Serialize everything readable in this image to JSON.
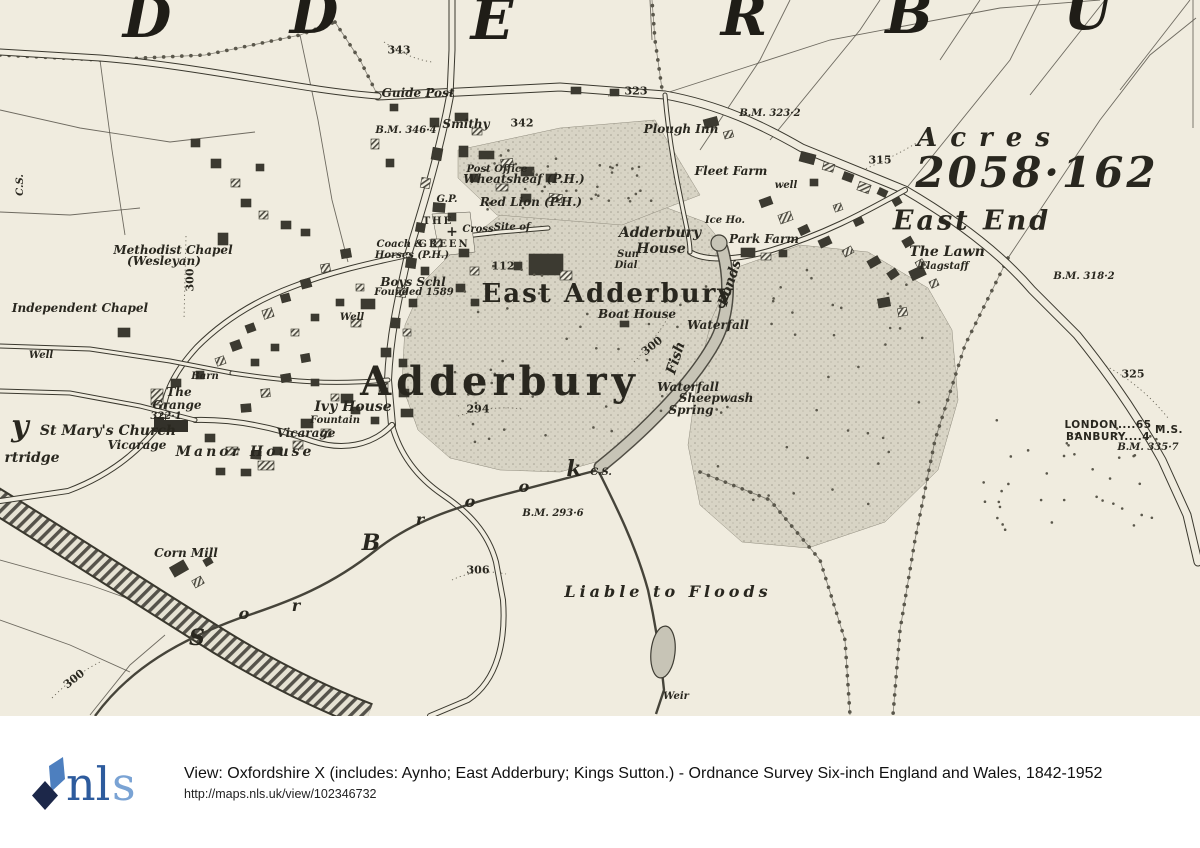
{
  "colors": {
    "paper": "#f0ecdf",
    "ink": "#3a382e",
    "line": "#57544a",
    "stipple_base": "#d8d4c5",
    "stipple_dot": "#a5a193",
    "water": "#c7c4b6",
    "tree": "#5a574b",
    "logo_light": "#4d7fbf",
    "logo_dark": "#1c2749",
    "nls_blue": "#2d5b9d",
    "nls_s": "#7aa3d4"
  },
  "footer": {
    "logo_nl": "nl",
    "logo_s": "s",
    "line1": "View: Oxfordshire X (includes: Aynho; East Adderbury; Kings Sutton.) - Ordnance Survey Six-inch England and Wales, 1842-1952",
    "line2": "http://maps.nls.uk/view/102346732"
  },
  "map": {
    "labels": [
      {
        "t": "D",
        "x": 147,
        "y": 18,
        "c": "g"
      },
      {
        "t": "D",
        "x": 314,
        "y": 14,
        "c": "g"
      },
      {
        "t": "E",
        "x": 492,
        "y": 20,
        "c": "g"
      },
      {
        "t": "R",
        "x": 744,
        "y": 16,
        "c": "g"
      },
      {
        "t": "B",
        "x": 909,
        "y": 14,
        "c": "g"
      },
      {
        "t": "U",
        "x": 1088,
        "y": 10,
        "c": "g"
      },
      {
        "t": "Acres",
        "x": 990,
        "y": 138,
        "c": "acres"
      },
      {
        "t": "2058·162",
        "x": 1037,
        "y": 173,
        "c": "acreage"
      },
      {
        "t": "East End",
        "x": 972,
        "y": 221,
        "c": "eastend"
      },
      {
        "t": "East Adderbury",
        "x": 608,
        "y": 294,
        "c": "town"
      },
      {
        "t": "Adderbury",
        "x": 500,
        "y": 382,
        "c": "townxl"
      },
      {
        "t": "Guide Post",
        "x": 418,
        "y": 93,
        "c": "p"
      },
      {
        "t": "Smithy",
        "x": 466,
        "y": 124,
        "c": "p"
      },
      {
        "t": "342",
        "x": 522,
        "y": 123,
        "c": "n"
      },
      {
        "t": "343",
        "x": 399,
        "y": 50,
        "c": "n"
      },
      {
        "t": "B.M. 346·4",
        "x": 406,
        "y": 131,
        "c": "bm"
      },
      {
        "t": "323",
        "x": 636,
        "y": 91,
        "c": "n"
      },
      {
        "t": "Plough Inn",
        "x": 681,
        "y": 129,
        "c": "p"
      },
      {
        "t": "B.M. 323·2",
        "x": 770,
        "y": 114,
        "c": "bm"
      },
      {
        "t": "Post Office",
        "x": 497,
        "y": 170,
        "c": "sm"
      },
      {
        "t": "Wheatsheaf (P.H.)",
        "x": 524,
        "y": 179,
        "c": "p"
      },
      {
        "t": "Red Lion (P.H.)",
        "x": 531,
        "y": 202,
        "c": "p"
      },
      {
        "t": "G.P.",
        "x": 447,
        "y": 200,
        "c": "sm"
      },
      {
        "t": "Fleet Farm",
        "x": 731,
        "y": 171,
        "c": "p"
      },
      {
        "t": "well",
        "x": 786,
        "y": 186,
        "c": "sm"
      },
      {
        "t": "315",
        "x": 880,
        "y": 160,
        "c": "n"
      },
      {
        "t": "Ice Ho.",
        "x": 725,
        "y": 221,
        "c": "sm"
      },
      {
        "t": "Park Farm",
        "x": 764,
        "y": 239,
        "c": "p"
      },
      {
        "t": "Adderbury",
        "x": 660,
        "y": 233,
        "c": "p2"
      },
      {
        "t": "House",
        "x": 661,
        "y": 249,
        "c": "p2"
      },
      {
        "t": "Sun",
        "x": 628,
        "y": 255,
        "c": "sm"
      },
      {
        "t": "Dial",
        "x": 626,
        "y": 266,
        "c": "sm"
      },
      {
        "t": "The Lawn",
        "x": 947,
        "y": 252,
        "c": "p2"
      },
      {
        "t": "Flagstaff",
        "x": 944,
        "y": 267,
        "c": "sm"
      },
      {
        "t": "B.M. 318·2",
        "x": 1084,
        "y": 277,
        "c": "bm"
      },
      {
        "t": "Methodist Chapel",
        "x": 173,
        "y": 250,
        "c": "p"
      },
      {
        "t": "(Wesleyan)",
        "x": 164,
        "y": 261,
        "c": "p"
      },
      {
        "t": "300",
        "x": 190,
        "y": 280,
        "c": "n",
        "r": -90
      },
      {
        "t": "Independent Chapel",
        "x": 80,
        "y": 308,
        "c": "p"
      },
      {
        "t": "Well",
        "x": 41,
        "y": 356,
        "c": "sm"
      },
      {
        "t": "Coach &",
        "x": 400,
        "y": 245,
        "c": "sm"
      },
      {
        "t": "Horses (P.H.)",
        "x": 412,
        "y": 256,
        "c": "sm"
      },
      {
        "t": "THE",
        "x": 438,
        "y": 222,
        "c": "green"
      },
      {
        "t": "GREEN",
        "x": 444,
        "y": 245,
        "c": "green"
      },
      {
        "t": "+",
        "x": 452,
        "y": 232,
        "c": "cross"
      },
      {
        "t": "Cross",
        "x": 478,
        "y": 230,
        "c": "sm"
      },
      {
        "t": "Site of",
        "x": 512,
        "y": 228,
        "c": "sm"
      },
      {
        "t": "112",
        "x": 503,
        "y": 266,
        "c": "n"
      },
      {
        "t": "Boys Schl",
        "x": 413,
        "y": 282,
        "c": "p"
      },
      {
        "t": "Founded 1589",
        "x": 414,
        "y": 293,
        "c": "sm"
      },
      {
        "t": "Well",
        "x": 352,
        "y": 318,
        "c": "sm"
      },
      {
        "t": "St Mary's Church",
        "x": 108,
        "y": 431,
        "c": "p2"
      },
      {
        "t": "Vicarage",
        "x": 137,
        "y": 445,
        "c": "p"
      },
      {
        "t": "The",
        "x": 179,
        "y": 392,
        "c": "p"
      },
      {
        "t": "Grange",
        "x": 177,
        "y": 405,
        "c": "p"
      },
      {
        "t": "Barn",
        "x": 205,
        "y": 377,
        "c": "sm"
      },
      {
        "t": "322·1",
        "x": 166,
        "y": 417,
        "c": "bm"
      },
      {
        "t": "Manor House",
        "x": 245,
        "y": 452,
        "c": "manor"
      },
      {
        "t": "Ivy House",
        "x": 353,
        "y": 407,
        "c": "p2"
      },
      {
        "t": "Fountain",
        "x": 335,
        "y": 421,
        "c": "sm"
      },
      {
        "t": "Vicarage",
        "x": 306,
        "y": 433,
        "c": "p"
      },
      {
        "t": "y",
        "x": 20,
        "y": 427,
        "c": "g2"
      },
      {
        "t": "rtridge",
        "x": 32,
        "y": 458,
        "c": "p2"
      },
      {
        "t": "Corn Mill",
        "x": 186,
        "y": 553,
        "c": "p"
      },
      {
        "t": "S",
        "x": 197,
        "y": 638,
        "c": "brook"
      },
      {
        "t": "o",
        "x": 244,
        "y": 614,
        "c": "brooksm"
      },
      {
        "t": "r",
        "x": 296,
        "y": 606,
        "c": "brooksm"
      },
      {
        "t": "B",
        "x": 371,
        "y": 543,
        "c": "brook"
      },
      {
        "t": "r",
        "x": 420,
        "y": 520,
        "c": "brooksm"
      },
      {
        "t": "o",
        "x": 470,
        "y": 502,
        "c": "brooksm"
      },
      {
        "t": "o",
        "x": 524,
        "y": 487,
        "c": "brooksm"
      },
      {
        "t": "k",
        "x": 574,
        "y": 469,
        "c": "brook"
      },
      {
        "t": "C.S.",
        "x": 601,
        "y": 473,
        "c": "sm"
      },
      {
        "t": "B.M. 293·6",
        "x": 553,
        "y": 514,
        "c": "bm"
      },
      {
        "t": "306",
        "x": 478,
        "y": 570,
        "c": "n"
      },
      {
        "t": "Liable to Floods",
        "x": 668,
        "y": 592,
        "c": "floods"
      },
      {
        "t": "Weir",
        "x": 676,
        "y": 697,
        "c": "sm"
      },
      {
        "t": "300",
        "x": 652,
        "y": 346,
        "c": "n",
        "r": -38
      },
      {
        "t": "294",
        "x": 478,
        "y": 409,
        "c": "n"
      },
      {
        "t": "Ponds",
        "x": 730,
        "y": 283,
        "c": "pondlbl",
        "r": -72
      },
      {
        "t": "Fish",
        "x": 676,
        "y": 358,
        "c": "pondlbl",
        "r": -72
      },
      {
        "t": "Boat House",
        "x": 637,
        "y": 314,
        "c": "p"
      },
      {
        "t": "Waterfall",
        "x": 718,
        "y": 325,
        "c": "p"
      },
      {
        "t": "Waterfall",
        "x": 688,
        "y": 387,
        "c": "p"
      },
      {
        "t": "Sheepwash",
        "x": 716,
        "y": 398,
        "c": "p"
      },
      {
        "t": "Spring",
        "x": 691,
        "y": 410,
        "c": "p"
      },
      {
        "t": "325",
        "x": 1133,
        "y": 374,
        "c": "n"
      },
      {
        "t": "LONDON....65",
        "x": 1108,
        "y": 425,
        "c": "dist"
      },
      {
        "t": "BANBURY....4",
        "x": 1108,
        "y": 437,
        "c": "dist"
      },
      {
        "t": "M.S.",
        "x": 1169,
        "y": 430,
        "c": "dist"
      },
      {
        "t": "B.M. 335·7",
        "x": 1148,
        "y": 448,
        "c": "bm"
      },
      {
        "t": "C.S.",
        "x": 21,
        "y": 185,
        "c": "sm",
        "r": -90
      },
      {
        "t": "300",
        "x": 74,
        "y": 679,
        "c": "n",
        "r": -38
      }
    ]
  }
}
